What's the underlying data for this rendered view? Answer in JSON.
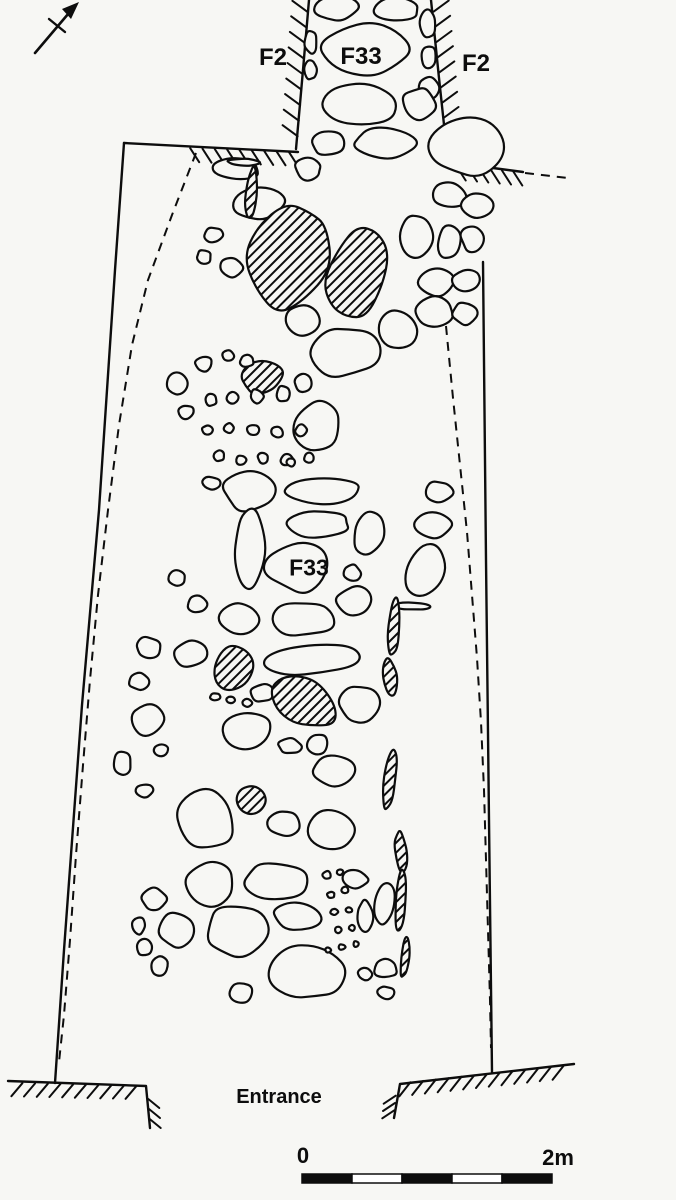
{
  "colors": {
    "background": "#f7f7f4",
    "ink": "#0d0d0d"
  },
  "labels": {
    "f2_left": "F2",
    "f33_top": "F33",
    "f2_right": "F2",
    "f33_mid": "F33",
    "entrance": "Entrance",
    "scale_zero": "0",
    "scale_end": "2m"
  },
  "scale_bar": {
    "x": 302,
    "y": 1174,
    "width": 250,
    "height": 9,
    "segments": 5
  },
  "diagram": {
    "north_arrow": {
      "shaft": [
        35,
        53,
        74,
        7
      ],
      "crossbar": [
        49,
        19,
        65,
        32
      ],
      "head": [
        [
          79,
          2
        ],
        [
          62,
          9
        ],
        [
          71,
          19
        ]
      ]
    },
    "outlines": [
      "M124,143 L115,270 L99,510 L82,705 L64,950 L55,1083",
      "M124,143 L298,152",
      "M309,0 L303,70 L296,149",
      "M431,0 L439,78 L448,162",
      "M448,162 L523,172",
      "M483,262 L486,560 L489,820 L492,1072",
      "M8,1081 L146,1086 L150,1128",
      "M394,1118 L400,1084 L574,1064"
    ],
    "dashed": [
      [
        [
          196,
          153
        ],
        [
          172,
          215
        ],
        [
          148,
          280
        ],
        [
          132,
          345
        ],
        [
          119,
          425
        ],
        [
          108,
          510
        ],
        [
          98,
          595
        ],
        [
          90,
          680
        ],
        [
          83,
          765
        ],
        [
          76,
          855
        ],
        [
          70,
          940
        ],
        [
          64,
          1015
        ],
        [
          59,
          1062
        ]
      ],
      [
        [
          446,
          326
        ],
        [
          453,
          398
        ],
        [
          460,
          465
        ],
        [
          467,
          532
        ],
        [
          472,
          595
        ],
        [
          477,
          658
        ],
        [
          481,
          722
        ],
        [
          484,
          790
        ],
        [
          486,
          860
        ],
        [
          488,
          930
        ],
        [
          490,
          1000
        ],
        [
          491,
          1048
        ]
      ],
      [
        [
          525,
          173
        ],
        [
          568,
          178
        ]
      ]
    ],
    "combs": [
      {
        "a": [
          308,
          4
        ],
        "b": [
          297,
          144
        ],
        "t": [
          -15,
          -11
        ],
        "n": 9
      },
      {
        "a": [
          433,
          4
        ],
        "b": [
          447,
          156
        ],
        "t": [
          15,
          -11
        ],
        "n": 10
      },
      {
        "a": [
          184,
          148
        ],
        "b": [
          295,
          152
        ],
        "t": [
          9,
          14
        ],
        "n": 9
      },
      {
        "a": [
          451,
          166
        ],
        "b": [
          519,
          172
        ],
        "t": [
          9,
          14
        ],
        "n": 6
      },
      {
        "a": [
          16,
          1083
        ],
        "b": [
          143,
          1086
        ],
        "t": [
          -11,
          13
        ],
        "n": 10
      },
      {
        "a": [
          148,
          1094
        ],
        "b": [
          150,
          1124
        ],
        "t": [
          11,
          9
        ],
        "n": 3
      },
      {
        "a": [
          404,
          1083
        ],
        "b": [
          570,
          1065
        ],
        "t": [
          -11,
          14
        ],
        "n": 13
      },
      {
        "a": [
          396,
          1092
        ],
        "b": [
          394,
          1114
        ],
        "t": [
          -12,
          8
        ],
        "n": 3
      }
    ],
    "stones": [
      [
        337,
        8,
        46,
        26,
        -4,
        0
      ],
      [
        396,
        10,
        50,
        26,
        3,
        0
      ],
      [
        366,
        52,
        94,
        54,
        -3,
        0
      ],
      [
        311,
        42,
        13,
        24,
        0,
        0
      ],
      [
        311,
        70,
        13,
        20,
        0,
        0
      ],
      [
        428,
        24,
        18,
        28,
        0,
        0
      ],
      [
        428,
        56,
        16,
        24,
        0,
        0
      ],
      [
        429,
        88,
        20,
        26,
        0,
        0
      ],
      [
        359,
        104,
        80,
        44,
        2,
        0
      ],
      [
        419,
        104,
        34,
        32,
        10,
        0
      ],
      [
        328,
        143,
        36,
        28,
        -6,
        0
      ],
      [
        384,
        143,
        64,
        34,
        2,
        0
      ],
      [
        468,
        147,
        82,
        60,
        -8,
        0
      ],
      [
        448,
        196,
        36,
        26,
        5,
        0
      ],
      [
        479,
        205,
        34,
        26,
        -5,
        0
      ],
      [
        416,
        236,
        34,
        42,
        0,
        0
      ],
      [
        449,
        243,
        26,
        34,
        6,
        0
      ],
      [
        472,
        238,
        24,
        30,
        -8,
        0
      ],
      [
        437,
        281,
        40,
        30,
        3,
        0
      ],
      [
        466,
        281,
        28,
        24,
        -5,
        0
      ],
      [
        434,
        312,
        42,
        32,
        -4,
        0
      ],
      [
        465,
        313,
        26,
        24,
        6,
        0
      ],
      [
        237,
        169,
        50,
        24,
        4,
        0
      ],
      [
        258,
        204,
        58,
        34,
        -6,
        0
      ],
      [
        308,
        169,
        28,
        22,
        8,
        0
      ],
      [
        214,
        235,
        20,
        16,
        0,
        0
      ],
      [
        204,
        257,
        16,
        14,
        0,
        0
      ],
      [
        244,
        162,
        36,
        7,
        2,
        0
      ],
      [
        251,
        194,
        11,
        54,
        4,
        1
      ],
      [
        297,
        236,
        36,
        28,
        -4,
        0
      ],
      [
        231,
        267,
        24,
        20,
        5,
        0
      ],
      [
        270,
        274,
        26,
        22,
        -6,
        0
      ],
      [
        289,
        255,
        82,
        118,
        18,
        1
      ],
      [
        356,
        275,
        62,
        108,
        20,
        1
      ],
      [
        262,
        377,
        42,
        34,
        -10,
        1
      ],
      [
        303,
        383,
        20,
        18,
        0,
        0
      ],
      [
        346,
        352,
        68,
        54,
        -8,
        0
      ],
      [
        399,
        330,
        44,
        40,
        6,
        0
      ],
      [
        301,
        320,
        38,
        32,
        4,
        0
      ],
      [
        318,
        428,
        48,
        54,
        -3,
        0
      ],
      [
        177,
        383,
        22,
        26,
        0,
        0
      ],
      [
        204,
        364,
        18,
        16,
        0,
        0
      ],
      [
        228,
        356,
        13,
        12,
        0,
        0
      ],
      [
        247,
        361,
        15,
        12,
        0,
        0
      ],
      [
        186,
        412,
        16,
        14,
        0,
        0
      ],
      [
        211,
        400,
        13,
        13,
        0,
        0
      ],
      [
        233,
        398,
        12,
        12,
        0,
        0
      ],
      [
        257,
        396,
        13,
        15,
        0,
        0
      ],
      [
        283,
        394,
        15,
        17,
        0,
        0
      ],
      [
        207,
        430,
        11,
        10,
        0,
        0
      ],
      [
        229,
        428,
        11,
        10,
        0,
        0
      ],
      [
        253,
        430,
        12,
        12,
        0,
        0
      ],
      [
        277,
        432,
        13,
        12,
        0,
        0
      ],
      [
        301,
        430,
        12,
        12,
        0,
        0
      ],
      [
        219,
        456,
        11,
        11,
        0,
        0
      ],
      [
        241,
        460,
        11,
        10,
        0,
        0
      ],
      [
        263,
        458,
        11,
        11,
        0,
        0
      ],
      [
        287,
        460,
        13,
        12,
        0,
        0
      ],
      [
        309,
        458,
        11,
        10,
        0,
        0
      ],
      [
        211,
        483,
        19,
        13,
        0,
        0
      ],
      [
        239,
        487,
        13,
        11,
        0,
        0
      ],
      [
        263,
        491,
        17,
        13,
        0,
        0
      ],
      [
        291,
        462,
        10,
        9,
        0,
        0
      ],
      [
        250,
        490,
        54,
        44,
        -5,
        0
      ],
      [
        325,
        491,
        80,
        27,
        2,
        0
      ],
      [
        250,
        548,
        33,
        78,
        2,
        0
      ],
      [
        319,
        524,
        68,
        30,
        -3,
        0
      ],
      [
        369,
        533,
        34,
        46,
        15,
        0
      ],
      [
        433,
        525,
        36,
        26,
        -5,
        0
      ],
      [
        425,
        573,
        40,
        56,
        20,
        0
      ],
      [
        438,
        492,
        30,
        22,
        0,
        0
      ],
      [
        298,
        566,
        66,
        52,
        -2,
        0
      ],
      [
        352,
        573,
        18,
        18,
        4,
        0
      ],
      [
        355,
        601,
        38,
        28,
        -6,
        0
      ],
      [
        411,
        606,
        38,
        8,
        3,
        0
      ],
      [
        394,
        626,
        12,
        62,
        4,
        1
      ],
      [
        390,
        677,
        14,
        38,
        -8,
        1
      ],
      [
        303,
        619,
        72,
        38,
        -3,
        0
      ],
      [
        240,
        619,
        40,
        34,
        6,
        0
      ],
      [
        177,
        578,
        18,
        16,
        0,
        0
      ],
      [
        197,
        605,
        22,
        18,
        -4,
        0
      ],
      [
        149,
        648,
        27,
        23,
        5,
        0
      ],
      [
        139,
        681,
        21,
        19,
        -6,
        0
      ],
      [
        263,
        693,
        25,
        19,
        4,
        0
      ],
      [
        190,
        654,
        36,
        26,
        -6,
        0
      ],
      [
        234,
        667,
        48,
        48,
        25,
        1
      ],
      [
        313,
        660,
        100,
        32,
        -4,
        0
      ],
      [
        301,
        701,
        72,
        48,
        35,
        1
      ],
      [
        360,
        703,
        44,
        40,
        -8,
        0
      ],
      [
        215,
        697,
        10,
        8,
        0,
        0
      ],
      [
        231,
        700,
        9,
        7,
        0,
        0
      ],
      [
        247,
        703,
        10,
        8,
        0,
        0
      ],
      [
        245,
        731,
        56,
        46,
        -3,
        0
      ],
      [
        148,
        719,
        32,
        34,
        -5,
        0
      ],
      [
        161,
        750,
        16,
        12,
        0,
        0
      ],
      [
        290,
        746,
        24,
        16,
        3,
        0
      ],
      [
        318,
        744,
        22,
        22,
        -6,
        0
      ],
      [
        333,
        770,
        44,
        32,
        4,
        0
      ],
      [
        206,
        820,
        60,
        64,
        -3,
        0
      ],
      [
        250,
        801,
        32,
        28,
        1,
        1
      ],
      [
        285,
        823,
        34,
        26,
        -5,
        0
      ],
      [
        331,
        831,
        50,
        44,
        -2,
        0
      ],
      [
        122,
        764,
        20,
        24,
        -4,
        0
      ],
      [
        145,
        790,
        18,
        14,
        0,
        0
      ],
      [
        390,
        778,
        13,
        68,
        6,
        1
      ],
      [
        401,
        851,
        12,
        44,
        -5,
        1
      ],
      [
        210,
        884,
        56,
        44,
        -4,
        0
      ],
      [
        276,
        881,
        66,
        42,
        3,
        0
      ],
      [
        355,
        879,
        26,
        20,
        5,
        0
      ],
      [
        384,
        903,
        22,
        42,
        8,
        0
      ],
      [
        154,
        900,
        26,
        24,
        -6,
        0
      ],
      [
        177,
        930,
        38,
        38,
        4,
        0
      ],
      [
        235,
        931,
        64,
        52,
        -3,
        0
      ],
      [
        298,
        917,
        54,
        28,
        6,
        0
      ],
      [
        365,
        916,
        16,
        32,
        -5,
        0
      ],
      [
        139,
        925,
        14,
        18,
        0,
        0
      ],
      [
        144,
        947,
        16,
        18,
        0,
        0
      ],
      [
        159,
        966,
        20,
        20,
        0,
        0
      ],
      [
        307,
        971,
        78,
        64,
        -2,
        0
      ],
      [
        241,
        993,
        26,
        22,
        4,
        0
      ],
      [
        365,
        974,
        15,
        13,
        0,
        0
      ],
      [
        386,
        969,
        24,
        20,
        -8,
        0
      ],
      [
        386,
        993,
        17,
        14,
        5,
        0
      ],
      [
        401,
        899,
        11,
        62,
        4,
        1
      ],
      [
        405,
        958,
        9,
        42,
        6,
        1
      ],
      [
        327,
        875,
        9,
        8,
        0,
        0
      ],
      [
        340,
        872,
        7,
        6,
        0,
        0
      ],
      [
        331,
        895,
        8,
        7,
        0,
        0
      ],
      [
        345,
        890,
        7,
        7,
        0,
        0
      ],
      [
        334,
        912,
        8,
        6,
        0,
        0
      ],
      [
        349,
        910,
        7,
        6,
        0,
        0
      ],
      [
        338,
        930,
        7,
        7,
        0,
        0
      ],
      [
        352,
        928,
        6,
        6,
        0,
        0
      ],
      [
        342,
        947,
        7,
        6,
        0,
        0
      ],
      [
        356,
        944,
        6,
        6,
        0,
        0
      ],
      [
        328,
        950,
        6,
        5,
        0,
        0
      ]
    ]
  }
}
